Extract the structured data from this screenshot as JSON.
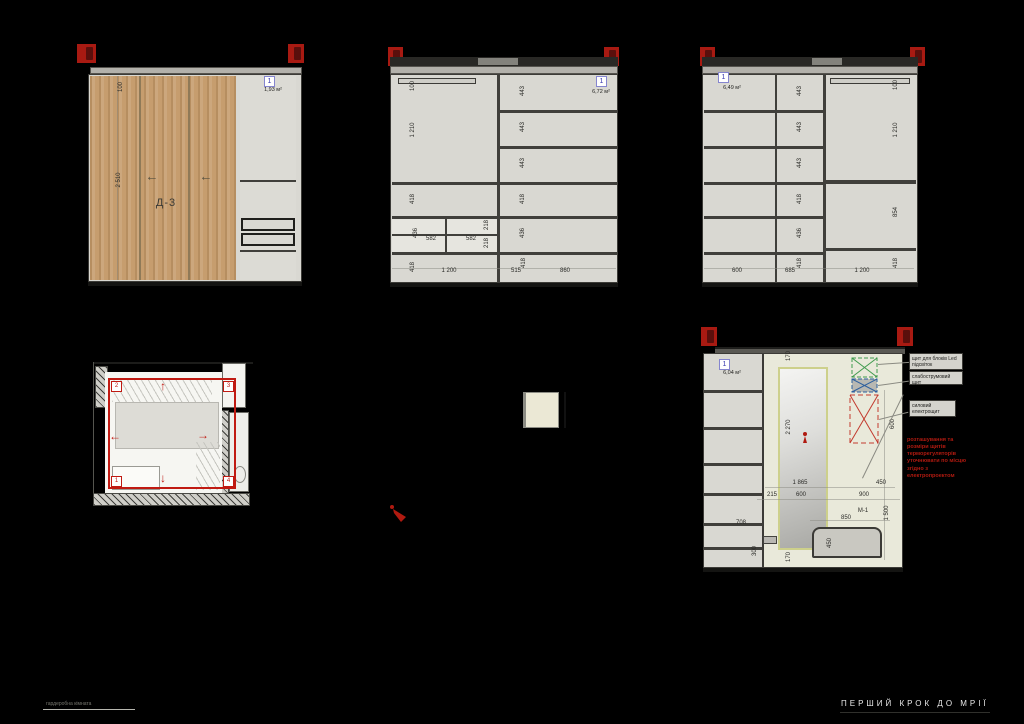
{
  "colors": {
    "background": "#000000",
    "accent_red": "#b01a12",
    "wood": "#c69d6e",
    "carcass": "#d9d8d2",
    "wall": "#e9e9da",
    "mirror_frame": "#cdd08b"
  },
  "icons": {
    "arrow_left": "←",
    "arrow_up": "↑",
    "arrow_right": "→",
    "arrow_down": "↓"
  },
  "front_view": {
    "badge": "1",
    "area": "1,93 м²",
    "door_label": "Д-3",
    "dim_top": "100",
    "dim_height": "2 510"
  },
  "left_elev": {
    "badge": "1",
    "area": "6,72 м²",
    "shelves": [
      "443",
      "443",
      "443",
      "418",
      "436"
    ],
    "dims": {
      "top": "100",
      "upper": "1 210",
      "mid": "418",
      "drawer_side": "436",
      "drawer_w1": "582",
      "drawer_w2": "582",
      "drawer_h1": "218",
      "drawer_h2": "218",
      "bottom": "418",
      "w_left": "1 200",
      "w_mid": "515",
      "bottom_right": "418",
      "w_right": "860"
    }
  },
  "right_elev": {
    "badge": "1",
    "area": "6,49 м²",
    "shelves": [
      "443",
      "443",
      "443",
      "418",
      "436",
      "418"
    ],
    "dims": {
      "w1": "600",
      "w2": "685",
      "top": "100",
      "upper": "1 210",
      "lower": "854",
      "bottom": "418",
      "w_right": "1 200"
    }
  },
  "plan": {
    "corner_1": "1",
    "corner_2": "2",
    "corner_3": "3",
    "corner_4": "4"
  },
  "hall_elev": {
    "badge": "1",
    "area": "6,04 м²",
    "dims": {
      "top": "170",
      "mirror_h": "2 270",
      "mirror_top": "1 865",
      "right_gap": "450",
      "left_gap": "215",
      "mirror_w": "600",
      "wall_right": "900",
      "bench_line": "1 500",
      "panel_h": "600",
      "bench_w": "850",
      "bench_label": "М-1",
      "bench_h": "450",
      "bottom": "170",
      "col_w": "708",
      "col_bottom": "300"
    },
    "annotations": {
      "led": "щит для блоків Led підсвіток",
      "low_current": "слабострумовий щит",
      "power": "силовий електрощит"
    },
    "note_lines": [
      "розташування та",
      "розміри щитів",
      "терморегуляторів",
      "уточнювати по місцю",
      "згідно з",
      "електропроектом"
    ]
  },
  "footer": {
    "caption": "гардеробна кімната",
    "brand": "ПЕРШИЙ КРОК ДО МРІЇ"
  }
}
